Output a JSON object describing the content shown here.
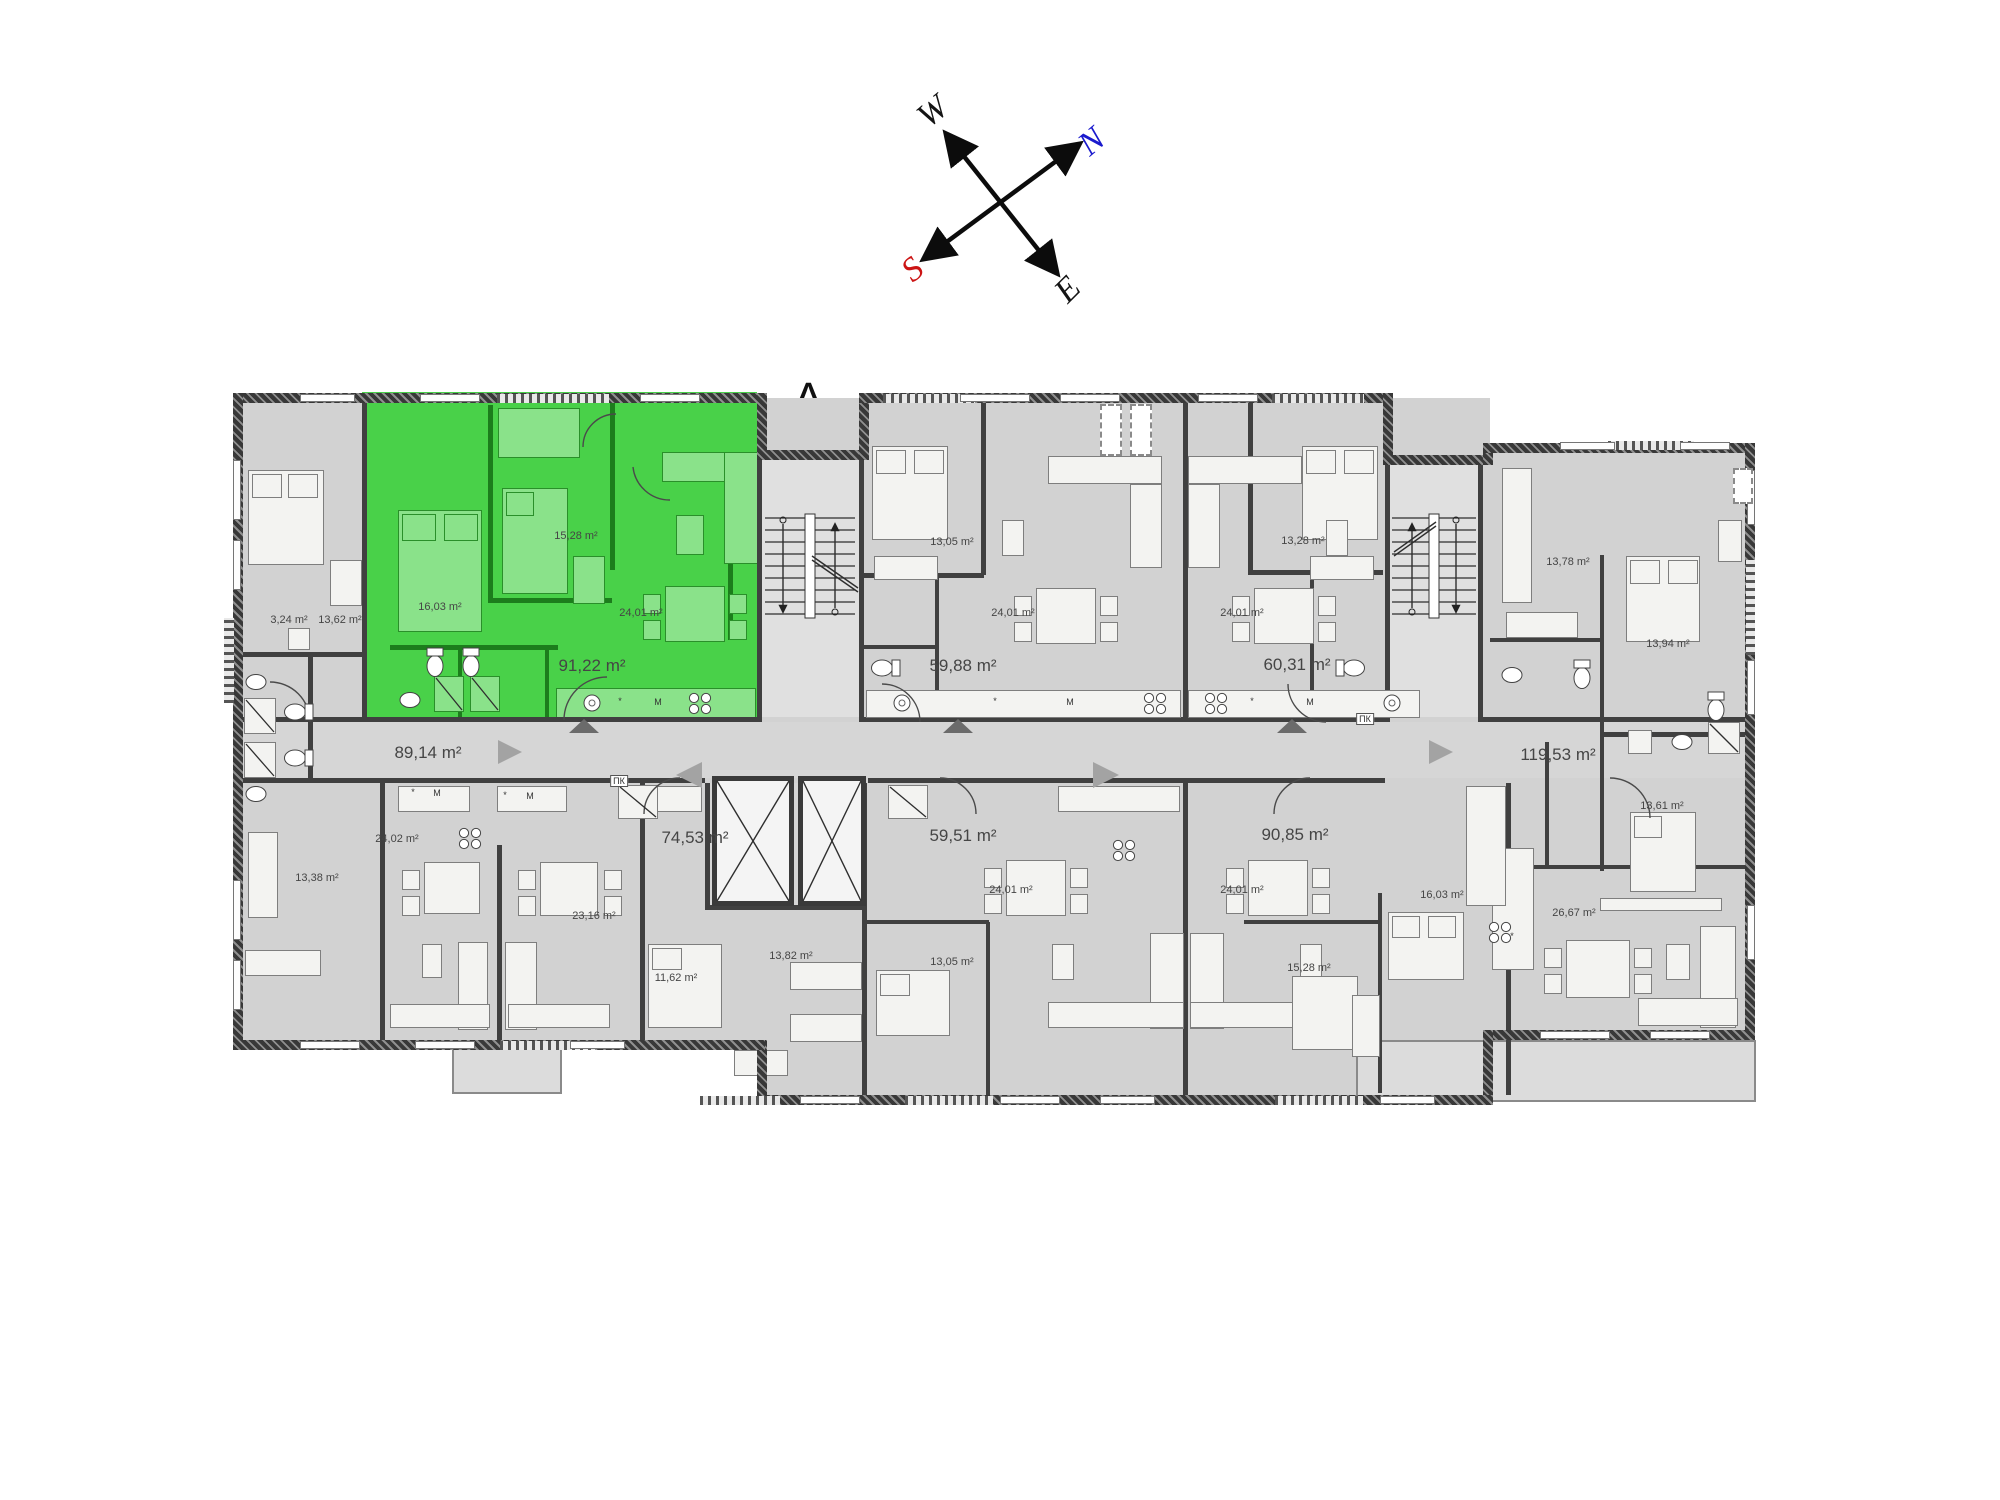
{
  "section_label": "A",
  "compass": {
    "north": "N",
    "south": "S",
    "east": "E",
    "west": "W",
    "north_color": "#1a1acd",
    "south_color": "#cc1414",
    "letter_color": "#141414"
  },
  "highlighted_unit": {
    "area_label": "91,22 m²",
    "fill_color": "#49d149",
    "rooms": [
      "16,03 m²",
      "15,28 m²",
      "24,01 m²"
    ]
  },
  "area_labels": [
    {
      "text": "89,14 m²",
      "x": 428,
      "y": 753,
      "size": "lg"
    },
    {
      "text": "91,22 m²",
      "x": 592,
      "y": 666,
      "size": "lg"
    },
    {
      "text": "74,53 m²",
      "x": 695,
      "y": 838,
      "size": "lg"
    },
    {
      "text": "59,88 m²",
      "x": 963,
      "y": 666,
      "size": "lg"
    },
    {
      "text": "60,31 m²",
      "x": 1297,
      "y": 665,
      "size": "lg"
    },
    {
      "text": "59,51 m²",
      "x": 963,
      "y": 836,
      "size": "lg"
    },
    {
      "text": "90,85 m²",
      "x": 1295,
      "y": 835,
      "size": "lg"
    },
    {
      "text": "119,53 m²",
      "x": 1558,
      "y": 755,
      "size": "lg"
    },
    {
      "text": "3,24 m²",
      "x": 289,
      "y": 620,
      "size": "sm"
    },
    {
      "text": "13,62 m²",
      "x": 340,
      "y": 620,
      "size": "sm"
    },
    {
      "text": "16,03 m²",
      "x": 440,
      "y": 607,
      "size": "sm"
    },
    {
      "text": "15,28 m²",
      "x": 576,
      "y": 536,
      "size": "sm"
    },
    {
      "text": "24,01 m²",
      "x": 641,
      "y": 613,
      "size": "sm"
    },
    {
      "text": "13,05 m²",
      "x": 952,
      "y": 542,
      "size": "sm"
    },
    {
      "text": "24,01 m²",
      "x": 1013,
      "y": 613,
      "size": "sm"
    },
    {
      "text": "24,01 m²",
      "x": 1242,
      "y": 613,
      "size": "sm"
    },
    {
      "text": "13,28 m²",
      "x": 1303,
      "y": 541,
      "size": "sm"
    },
    {
      "text": "13,78 m²",
      "x": 1568,
      "y": 562,
      "size": "sm"
    },
    {
      "text": "13,94 m²",
      "x": 1668,
      "y": 644,
      "size": "sm"
    },
    {
      "text": "13,38 m²",
      "x": 317,
      "y": 878,
      "size": "sm"
    },
    {
      "text": "24,02 m²",
      "x": 397,
      "y": 839,
      "size": "sm"
    },
    {
      "text": "23,16 m²",
      "x": 594,
      "y": 916,
      "size": "sm"
    },
    {
      "text": "11,62 m²",
      "x": 676,
      "y": 978,
      "size": "sm"
    },
    {
      "text": "13,82 m²",
      "x": 791,
      "y": 956,
      "size": "sm"
    },
    {
      "text": "13,05 m²",
      "x": 952,
      "y": 962,
      "size": "sm"
    },
    {
      "text": "24,01 m²",
      "x": 1011,
      "y": 890,
      "size": "sm"
    },
    {
      "text": "24,01 m²",
      "x": 1242,
      "y": 890,
      "size": "sm"
    },
    {
      "text": "15,28 m²",
      "x": 1309,
      "y": 968,
      "size": "sm"
    },
    {
      "text": "16,03 m²",
      "x": 1442,
      "y": 895,
      "size": "sm"
    },
    {
      "text": "26,67 m²",
      "x": 1574,
      "y": 913,
      "size": "sm"
    },
    {
      "text": "13,61 m²",
      "x": 1662,
      "y": 806,
      "size": "sm"
    }
  ],
  "utility_labels": [
    {
      "text": "ПК",
      "x": 619,
      "y": 781
    },
    {
      "text": "ПК",
      "x": 1365,
      "y": 719
    }
  ],
  "kitchen_markers": [
    {
      "text": "*",
      "x": 620,
      "y": 701
    },
    {
      "text": "M",
      "x": 658,
      "y": 702
    },
    {
      "text": "*",
      "x": 995,
      "y": 701
    },
    {
      "text": "M",
      "x": 1070,
      "y": 702
    },
    {
      "text": "*",
      "x": 1252,
      "y": 701
    },
    {
      "text": "M",
      "x": 1310,
      "y": 702
    },
    {
      "text": "*",
      "x": 413,
      "y": 792
    },
    {
      "text": "M",
      "x": 437,
      "y": 793
    },
    {
      "text": "*",
      "x": 505,
      "y": 795
    },
    {
      "text": "M",
      "x": 530,
      "y": 796
    },
    {
      "text": "*",
      "x": 1512,
      "y": 936
    }
  ]
}
